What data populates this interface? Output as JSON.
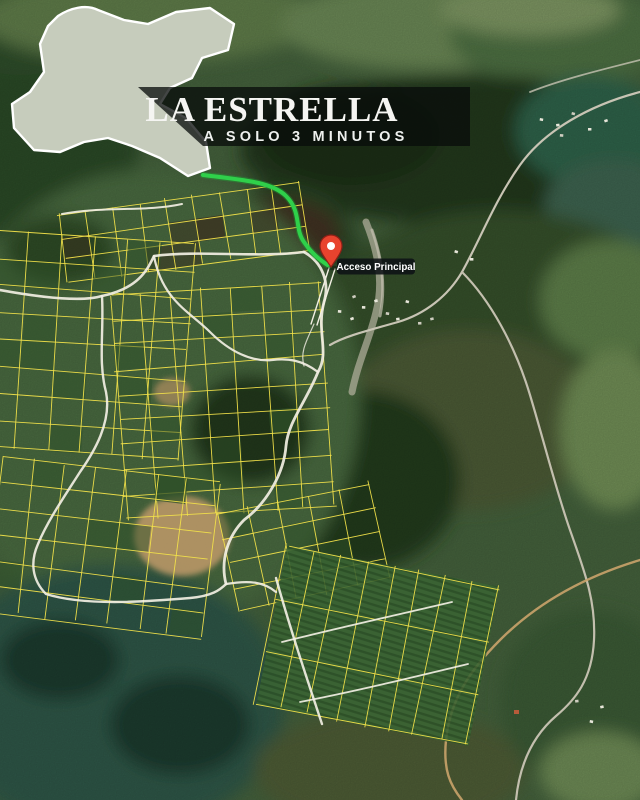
{
  "banner": {
    "title": "LA ESTRELLA",
    "subtitle": "A SOLO 3 MINUTOS"
  },
  "marker": {
    "label": "Acceso Principal"
  },
  "colors": {
    "route_green": "#2fd04a",
    "route_green_halo": "#1da435",
    "parcel_yellow": "#f3e24a",
    "road_white": "#f2efe3",
    "pin_red": "#e8432e",
    "pin_border": "#8f1f16",
    "pin_dot": "#ffffff",
    "banner_bg": "rgba(8,12,10,0.76)",
    "label_bg": "rgba(14,18,22,0.88)",
    "title_color": "#f5f5f2",
    "subtitle_color": "#eef0ee",
    "town_outline": "#ffffff"
  }
}
